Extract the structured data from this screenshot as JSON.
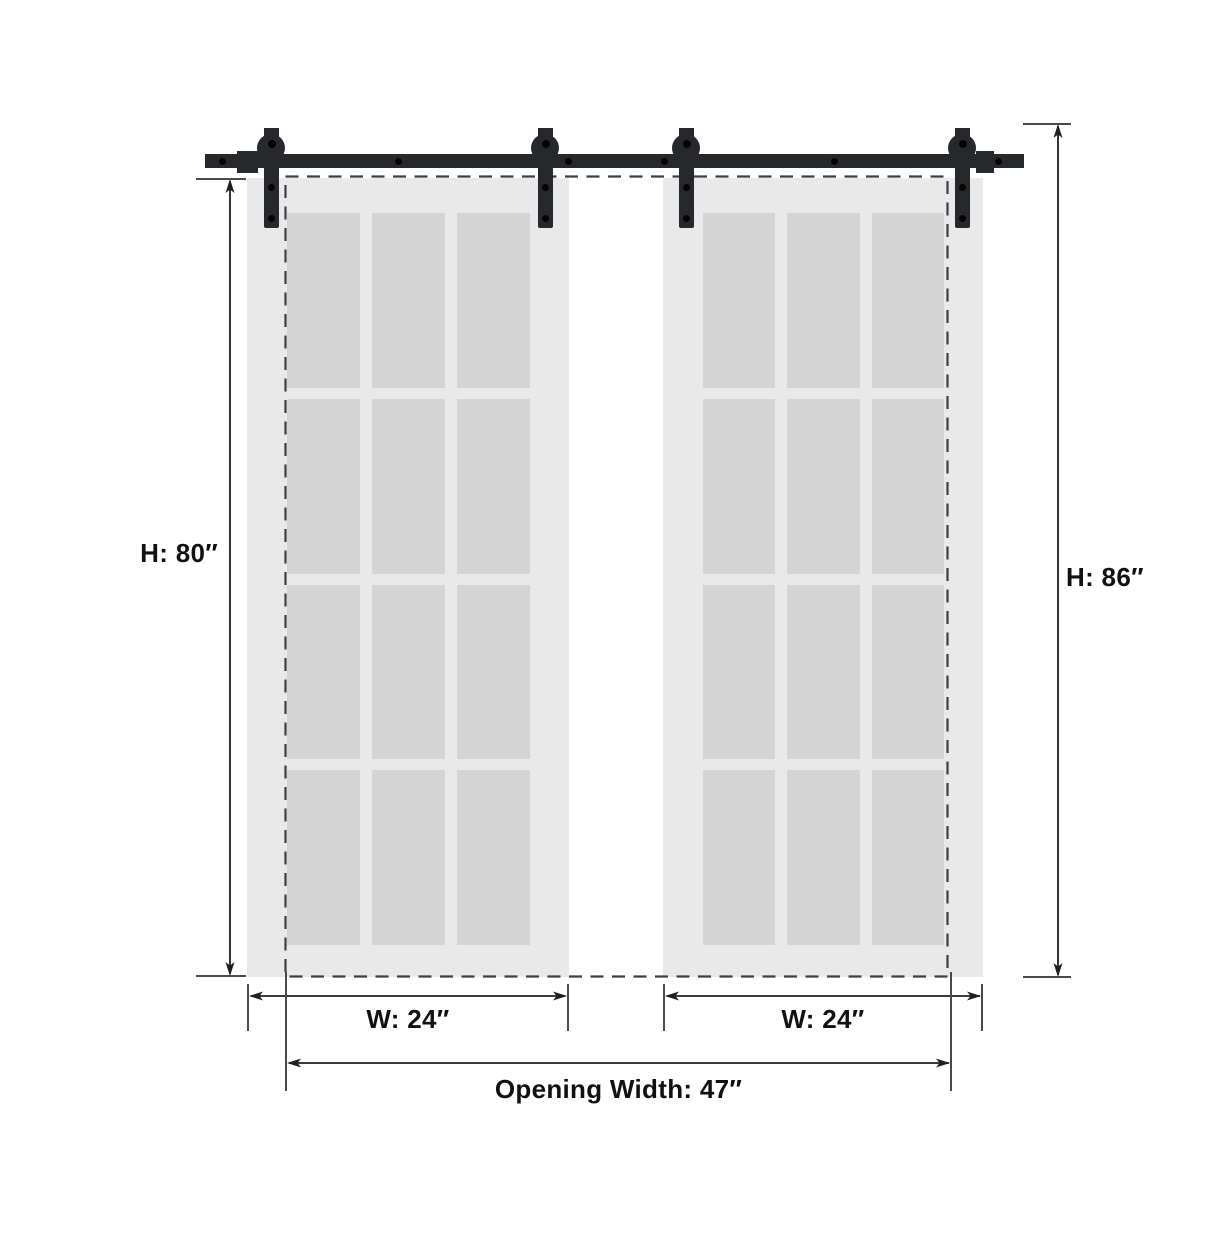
{
  "labels": {
    "door_height": "H: 80″",
    "overall_height": "H: 86″",
    "left_door_width": "W: 24″",
    "right_door_width": "W: 24″",
    "opening_width": "Opening Width: 47″"
  },
  "doors": {
    "count": 2,
    "lite_rows": 4,
    "lite_cols": 3
  },
  "hardware": {
    "hanger_count": 4,
    "rail_screw_count": 6
  },
  "colors": {
    "hardware": "#26282b",
    "door_face": "#e9e9e9",
    "glass_pane": "#d4d4d4",
    "dimension_line": "#1f1f1f",
    "tick": "#4a4a4a",
    "dashed_outline": "#3f3f3f",
    "label_text": "#111111",
    "background": "#ffffff"
  }
}
